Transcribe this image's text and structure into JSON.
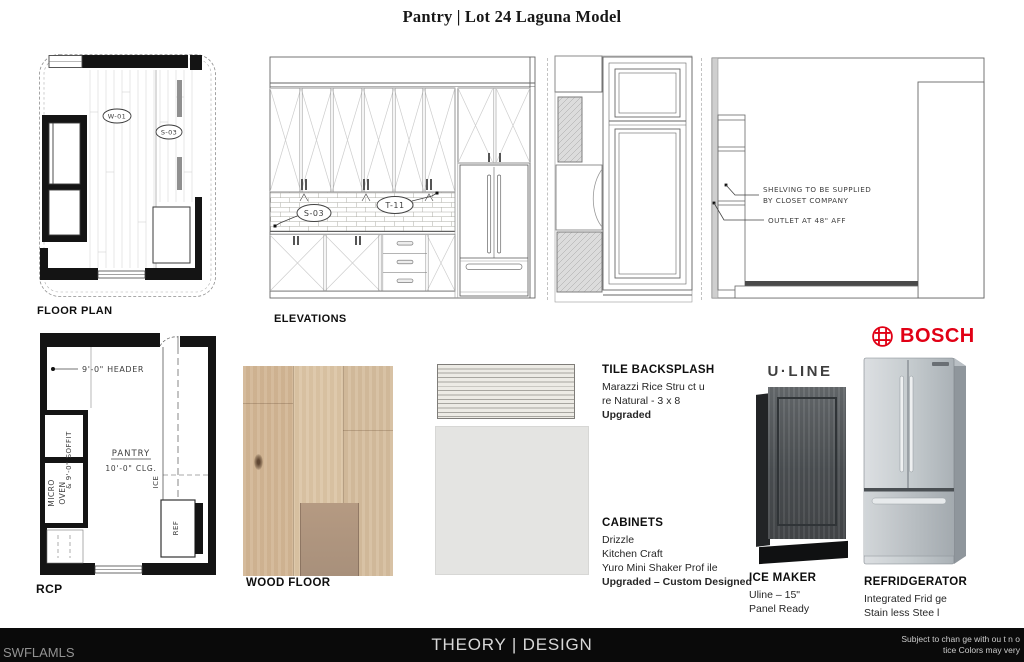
{
  "title": "Pantry | Lot 24 Laguna Model",
  "floor_plan": {
    "label": "FLOOR PLAN",
    "w01": "W-01",
    "s03": "S-03"
  },
  "elevations": {
    "label": "ELEVATIONS",
    "t11": "T-11",
    "s03": "S-03",
    "shelving_note_1": "SHELVING TO BE SUPPLIED",
    "shelving_note_2": "BY CLOSET COMPANY",
    "outlet_note": "OUTLET AT 48\" AFF"
  },
  "rcp": {
    "label": "RCP",
    "header": "9'-0\" HEADER",
    "room": "PANTRY",
    "ceiling": "10'-0\" CLG.",
    "soffit": "& 9'-0\" SOFFIT",
    "micro": "MICRO",
    "oven": "OVEN",
    "ice": "ICE",
    "ref": "REF"
  },
  "samples": {
    "wood_floor_label": "WOOD FLOOR",
    "tile": {
      "title": "TILE BACKSPLASH",
      "line1": "Marazzi Rice Stru ct u",
      "line2": "re Natural - 3 x 8",
      "line3": "Upgraded"
    },
    "cabinets": {
      "title": "CABINETS",
      "line1": "Drizzle",
      "line2": "Kitchen Craft",
      "line3": "Yuro Mini Shaker Prof ile",
      "line4": "Upgraded – Custom Designed"
    }
  },
  "appliances": {
    "uline_logo": "U·LINE",
    "ice_maker": {
      "title": "ICE MAKER",
      "line1": "Uline – 15\"",
      "line2": "Panel Ready"
    },
    "bosch_logo": "BOSCH",
    "fridge": {
      "title": "REFRIDGERATOR",
      "line1": "Integrated Frid ge",
      "line2": "Stain less Stee l"
    }
  },
  "footer": {
    "watermark": "SWFLAMLS",
    "brand": "THEORY | DESIGN",
    "disclaimer1": "Subject to chan ge with ou t n o",
    "disclaimer2": "tice Colors may very"
  },
  "colors": {
    "bosch_red": "#e10015",
    "footer_bg": "#0a0a0a",
    "drizzle": "#e4e4e2",
    "wood": "#d5bd9e"
  }
}
